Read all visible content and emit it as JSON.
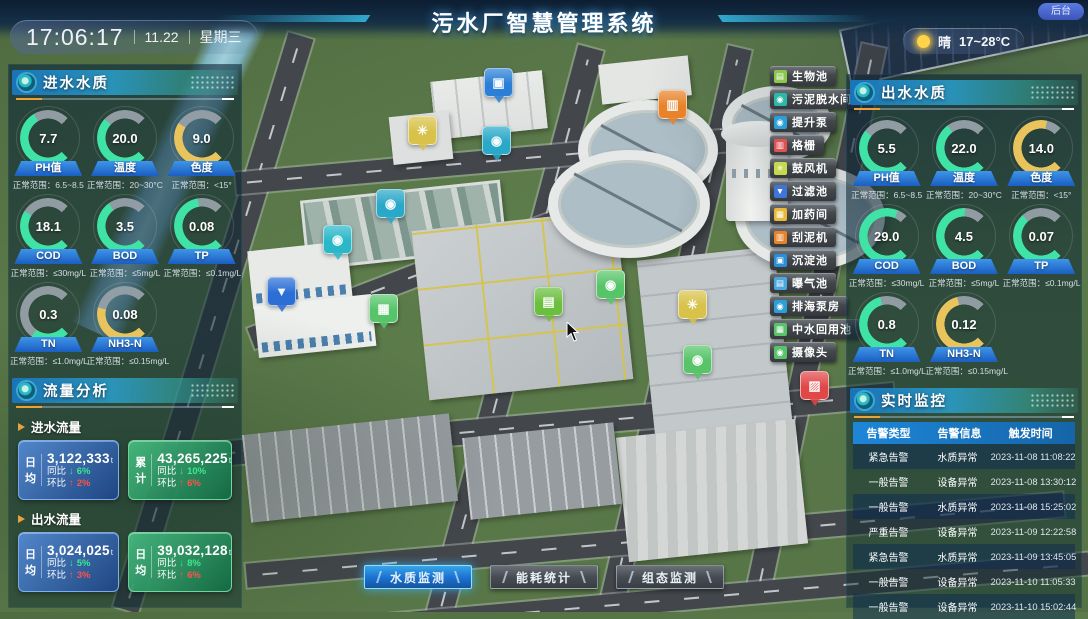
{
  "header": {
    "title": "污水厂智慧管理系统",
    "time": "17:06:17",
    "date": "11.22",
    "weekday": "星期三",
    "weather": {
      "condition": "晴",
      "temp": "17~28°C"
    },
    "backend": "后台"
  },
  "colors": {
    "gauge_normal": "#3fe3a5",
    "gauge_warn": "#e9c35b",
    "rise_red": "#ff5348",
    "fall_green": "#3fe88f"
  },
  "inlet_quality": {
    "title": "进水水质",
    "gauges": [
      {
        "value": "7.7",
        "label": "PH值",
        "range": "正常范围：6.5~8.5",
        "color": "#3fe3a5",
        "pct": 72
      },
      {
        "value": "20.0",
        "label": "温度",
        "range": "正常范围：20~30°C",
        "color": "#3fe3a5",
        "pct": 66
      },
      {
        "value": "9.0",
        "label": "色度",
        "range": "正常范围：<15°",
        "color": "#e9c35b",
        "pct": 62
      },
      {
        "value": "18.1",
        "label": "COD",
        "range": "正常范围：≤30mg/L",
        "color": "#3fe3a5",
        "pct": 62
      },
      {
        "value": "3.5",
        "label": "BOD",
        "range": "正常范围：≤5mg/L",
        "color": "#3fe3a5",
        "pct": 70
      },
      {
        "value": "0.08",
        "label": "TP",
        "range": "正常范围：≤0.1mg/L",
        "color": "#3fe3a5",
        "pct": 80
      },
      {
        "value": "0.3",
        "label": "TN",
        "range": "正常范围：≤1.0mg/L",
        "color": "#3fe3a5",
        "pct": 30
      },
      {
        "value": "0.08",
        "label": "NH3-N",
        "range": "正常范围：≤0.15mg/L",
        "color": "#e9c35b",
        "pct": 55
      }
    ]
  },
  "flow": {
    "title": "流量分析",
    "inlet": {
      "name": "进水流量",
      "cards": [
        {
          "tag": "日均",
          "value": "3,122,333",
          "unit": "t",
          "style": "blue",
          "yoy_label": "同比",
          "yoy_arrow": "↓",
          "yoy": "6%",
          "mom_label": "环比",
          "mom_arrow": "↑",
          "mom": "2%"
        },
        {
          "tag": "累计",
          "value": "43,265,225",
          "unit": "t",
          "style": "green",
          "yoy_label": "同比",
          "yoy_arrow": "↓",
          "yoy": "10%",
          "mom_label": "环比",
          "mom_arrow": "↑",
          "mom": "6%"
        }
      ]
    },
    "outlet": {
      "name": "出水流量",
      "cards": [
        {
          "tag": "日均",
          "value": "3,024,025",
          "unit": "t",
          "style": "blue",
          "yoy_label": "同比",
          "yoy_arrow": "↓",
          "yoy": "5%",
          "mom_label": "环比",
          "mom_arrow": "↑",
          "mom": "3%"
        },
        {
          "tag": "日均",
          "value": "39,032,128",
          "unit": "t",
          "style": "green",
          "yoy_label": "同比",
          "yoy_arrow": "↓",
          "yoy": "8%",
          "mom_label": "环比",
          "mom_arrow": "↑",
          "mom": "6%"
        }
      ]
    }
  },
  "outlet_quality": {
    "title": "出水水质",
    "gauges": [
      {
        "value": "5.5",
        "label": "PH值",
        "range": "正常范围：6.5~8.5",
        "color": "#3fe3a5",
        "pct": 64
      },
      {
        "value": "22.0",
        "label": "温度",
        "range": "正常范围：20~30°C",
        "color": "#3fe3a5",
        "pct": 70
      },
      {
        "value": "14.0",
        "label": "色度",
        "range": "正常范围：<15°",
        "color": "#e9c35b",
        "pct": 88
      },
      {
        "value": "29.0",
        "label": "COD",
        "range": "正常范围：≤30mg/L",
        "color": "#3fe3a5",
        "pct": 92
      },
      {
        "value": "4.5",
        "label": "BOD",
        "range": "正常范围：≤5mg/L",
        "color": "#3fe3a5",
        "pct": 84
      },
      {
        "value": "0.07",
        "label": "TP",
        "range": "正常范围：≤0.1mg/L",
        "color": "#3fe3a5",
        "pct": 68
      },
      {
        "value": "0.8",
        "label": "TN",
        "range": "正常范围：≤1.0mg/L",
        "color": "#3fe3a5",
        "pct": 78
      },
      {
        "value": "0.12",
        "label": "NH3-N",
        "range": "正常范围：≤0.15mg/L",
        "color": "#e9c35b",
        "pct": 78
      }
    ]
  },
  "monitor": {
    "title": "实时监控",
    "columns": [
      "告警类型",
      "告警信息",
      "触发时间"
    ],
    "rows": [
      {
        "type": "紧急告警",
        "info": "水质异常",
        "time": "2023-11-08 11:08:22"
      },
      {
        "type": "一般告警",
        "info": "设备异常",
        "time": "2023-11-08 13:30:12"
      },
      {
        "type": "一般告警",
        "info": "水质异常",
        "time": "2023-11-08 15:25:02"
      },
      {
        "type": "严重告警",
        "info": "设备异常",
        "time": "2023-11-09 12:22:58"
      },
      {
        "type": "紧急告警",
        "info": "水质异常",
        "time": "2023-11-09 13:45:05"
      },
      {
        "type": "一般告警",
        "info": "设备异常",
        "time": "2023-11-10 11:05:33"
      },
      {
        "type": "一般告警",
        "info": "设备异常",
        "time": "2023-11-10 15:02:44"
      }
    ]
  },
  "legend": {
    "items": [
      {
        "label": "生物池",
        "color": "#8bc84a",
        "glyph": "▤",
        "icon": "bio-pool-icon"
      },
      {
        "label": "污泥脱水间",
        "color": "#2ab8a8",
        "glyph": "◉",
        "icon": "sludge-dewatering-icon"
      },
      {
        "label": "提升泵",
        "color": "#2a9fd8",
        "glyph": "◉",
        "icon": "lift-pump-icon"
      },
      {
        "label": "格栅",
        "color": "#e05252",
        "glyph": "▥",
        "icon": "bar-screen-icon"
      },
      {
        "label": "鼓风机",
        "color": "#c6d84e",
        "glyph": "✳",
        "icon": "blower-icon"
      },
      {
        "label": "过滤池",
        "color": "#3f74d8",
        "glyph": "▼",
        "icon": "filter-pool-icon"
      },
      {
        "label": "加药间",
        "color": "#e8b83a",
        "glyph": "▦",
        "icon": "dosing-room-icon"
      },
      {
        "label": "刮泥机",
        "color": "#e8832a",
        "glyph": "▥",
        "icon": "sludge-scraper-icon"
      },
      {
        "label": "沉淀池",
        "color": "#2a8fd8",
        "glyph": "▣",
        "icon": "sedimentation-pool-icon"
      },
      {
        "label": "曝气池",
        "color": "#4aa8e0",
        "glyph": "▤",
        "icon": "aeration-pool-icon"
      },
      {
        "label": "排海泵房",
        "color": "#2a9fd8",
        "glyph": "◉",
        "icon": "sea-discharge-pump-icon"
      },
      {
        "label": "中水回用池",
        "color": "#57c46a",
        "glyph": "▦",
        "icon": "water-reuse-pool-icon"
      },
      {
        "label": "摄像头",
        "color": "#57c46a",
        "glyph": "◉",
        "icon": "camera-icon"
      }
    ]
  },
  "markers": [
    {
      "x": 498,
      "y": 82,
      "color": "#2b7fd6",
      "glyph": "▣",
      "icon": "sedimentation-marker-icon"
    },
    {
      "x": 422,
      "y": 130,
      "color": "#d8c24a",
      "glyph": "✳",
      "icon": "blower-marker-icon"
    },
    {
      "x": 496,
      "y": 140,
      "color": "#2aa8c8",
      "glyph": "◉",
      "icon": "pump-marker-icon"
    },
    {
      "x": 672,
      "y": 104,
      "color": "#e8832a",
      "glyph": "▥",
      "icon": "scraper-marker-icon"
    },
    {
      "x": 390,
      "y": 203,
      "color": "#2aa8c8",
      "glyph": "◉",
      "icon": "pump-marker-icon"
    },
    {
      "x": 337,
      "y": 239,
      "color": "#2ab8c8",
      "glyph": "◉",
      "icon": "pump-marker-icon"
    },
    {
      "x": 281,
      "y": 291,
      "color": "#2b6fd6",
      "glyph": "▼",
      "icon": "filter-marker-icon"
    },
    {
      "x": 383,
      "y": 308,
      "color": "#57c46a",
      "glyph": "▦",
      "icon": "reuse-pool-marker-icon"
    },
    {
      "x": 610,
      "y": 284,
      "color": "#57c46a",
      "glyph": "◉",
      "icon": "camera-marker-icon"
    },
    {
      "x": 548,
      "y": 301,
      "color": "#6bbf3f",
      "glyph": "▤",
      "icon": "bio-pool-marker-icon"
    },
    {
      "x": 692,
      "y": 304,
      "color": "#d8c24a",
      "glyph": "✳",
      "icon": "blower-marker-icon"
    },
    {
      "x": 697,
      "y": 359,
      "color": "#57c46a",
      "glyph": "◉",
      "icon": "camera-marker-icon"
    },
    {
      "x": 814,
      "y": 385,
      "color": "#e04848",
      "glyph": "▨",
      "icon": "bar-screen-marker-icon"
    }
  ],
  "footer": {
    "tabs": [
      {
        "label": "水质监测",
        "state": "active"
      },
      {
        "label": "能耗统计",
        "state": ""
      },
      {
        "label": "组态监测",
        "state": ""
      }
    ]
  }
}
